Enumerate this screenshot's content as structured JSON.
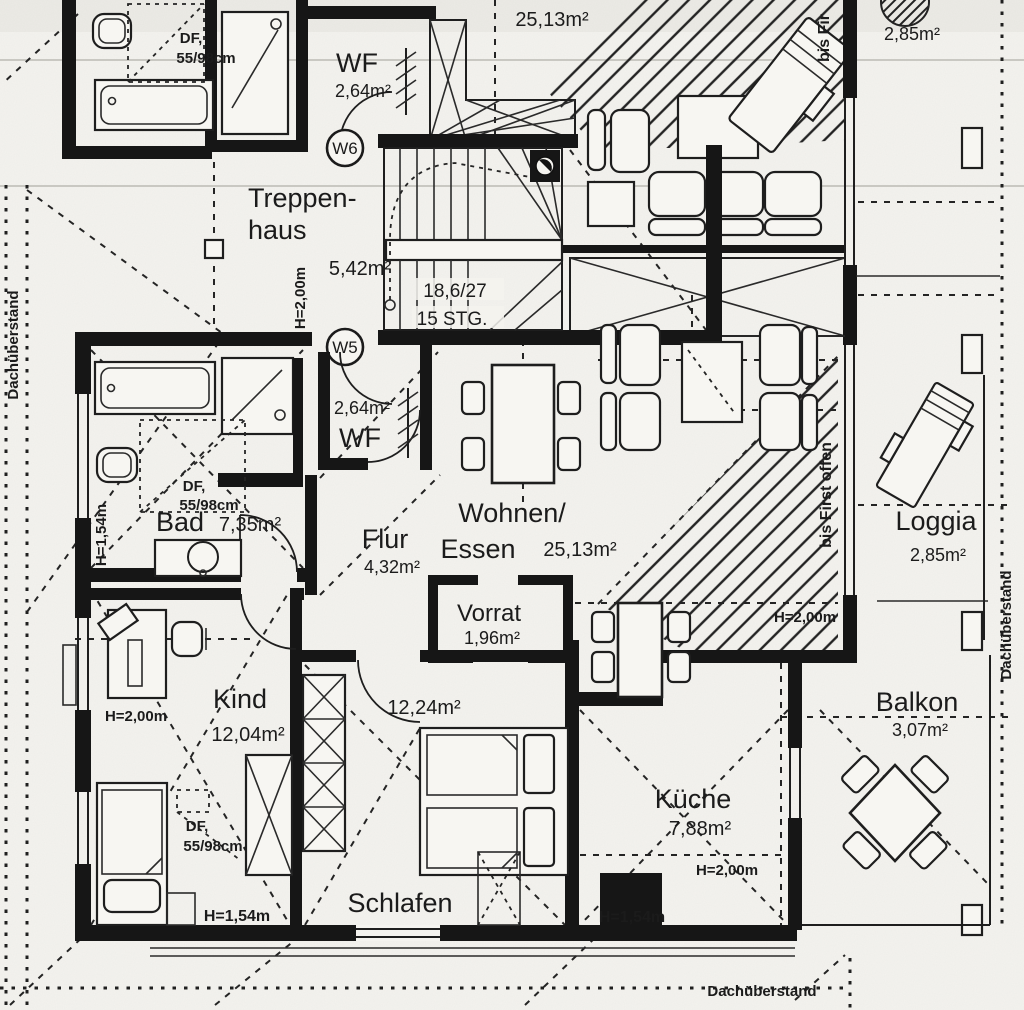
{
  "drawing": {
    "kind": "scanned architectural floor plan, attic storey with two flats",
    "paper_color": "#f4f3ef",
    "ink_color": "#1b1b1b"
  },
  "units": {
    "w5": "W5",
    "w6": "W6"
  },
  "stairs": {
    "riser_tread": "18,6/27",
    "steps": "15 STG."
  },
  "rooms": {
    "upper_wohnen_area": "25,13m²",
    "upper_loggia_area": "2,85m²",
    "wf_upper": {
      "name": "WF",
      "area": "2,64m²"
    },
    "treppenhaus": {
      "line1": "Treppen-",
      "line2": "haus",
      "area": "5,42m²"
    },
    "wf_main": {
      "name": "WF",
      "area": "2,64m²"
    },
    "bad": {
      "name": "Bad",
      "area": "7,35m²"
    },
    "flur": {
      "name": "Flur",
      "area": "4,32m²"
    },
    "wohnen": {
      "line1": "Wohnen/",
      "line2": "Essen",
      "area": "25,13m²"
    },
    "vorrat": {
      "name": "Vorrat",
      "area": "1,96m²"
    },
    "kind": {
      "name": "Kind",
      "area": "12,04m²"
    },
    "schlafen": {
      "name": "Schlafen",
      "area": "12,24m²"
    },
    "kueche": {
      "name": "Küche",
      "area": "7,88m²"
    },
    "loggia": {
      "name": "Loggia",
      "area": "2,85m²"
    },
    "balkon": {
      "name": "Balkon",
      "area": "3,07m²"
    }
  },
  "annotations": {
    "df_dormer": {
      "label": "DF,",
      "size": "55/98cm"
    },
    "df_bad": {
      "label": "DF,",
      "size": "55/98cm"
    },
    "df_kind": {
      "label": "DF,",
      "size": "55/98cm"
    },
    "height_200_stair": "H=2,00m",
    "height_154_bad": "H=1,54m",
    "height_200_kind": "H=2,00m",
    "height_200_wohnen": "H=2,00m",
    "height_200_kueche": "H=2,00m",
    "height_154_schlafen_wall": "H=1,54m",
    "height_154_kueche_wall": "H=1,54m",
    "bis_first_top": "bis Fir",
    "bis_first_offen": "bis First offen",
    "dachueberstand_left": "Dachüberstand",
    "dachueberstand_right": "Dachüberstand",
    "dachueberstand_bottom": "Dachüberstand"
  }
}
